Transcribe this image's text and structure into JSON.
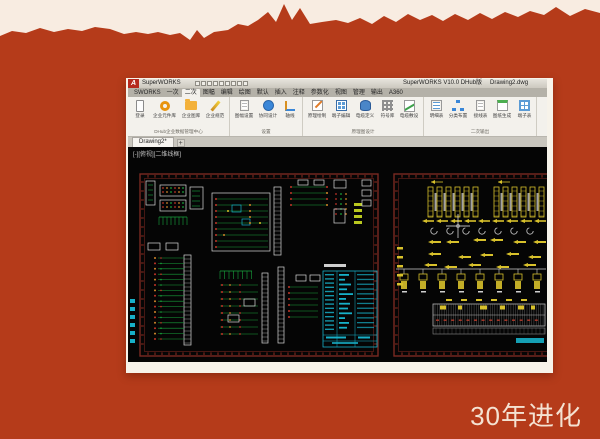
{
  "slide": {
    "caption": "30年进化"
  },
  "window": {
    "titlebar": {
      "app_logo": "A",
      "product_name": "SuperWORKS",
      "document_title": "SuperWORKS V10.0 DHub版",
      "document_name": "Drawing2.dwg",
      "quick_access_icons": [
        "new-file-icon",
        "open-file-icon",
        "save-icon",
        "save-as-icon",
        "undo-icon",
        "redo-icon",
        "plot-icon",
        "refresh-icon",
        "customize-dropdown-icon"
      ]
    },
    "ribbon": {
      "tabs": [
        {
          "label": "SWORKS",
          "active": false
        },
        {
          "label": "一次",
          "active": false
        },
        {
          "label": "二次",
          "active": true
        },
        {
          "label": "图幅",
          "active": false
        },
        {
          "label": "编辑",
          "active": false
        },
        {
          "label": "绘图",
          "active": false
        },
        {
          "label": "默认",
          "active": false
        },
        {
          "label": "插入",
          "active": false
        },
        {
          "label": "注释",
          "active": false
        },
        {
          "label": "参数化",
          "active": false
        },
        {
          "label": "视图",
          "active": false
        },
        {
          "label": "管理",
          "active": false
        },
        {
          "label": "输出",
          "active": false
        },
        {
          "label": "A360",
          "active": false
        }
      ],
      "groups": [
        {
          "label": "DHub企业数据管理中心",
          "buttons": [
            {
              "label": "登录",
              "icon": "tablet-icon"
            },
            {
              "label": "企业元件库",
              "icon": "ring-icon"
            },
            {
              "label": "企业图库",
              "icon": "folder-icon"
            },
            {
              "label": "企业规范",
              "icon": "wand-icon"
            }
          ]
        },
        {
          "label": "设置",
          "buttons": [
            {
              "label": "图幅设置",
              "icon": "doc-icon"
            },
            {
              "label": "协同设计",
              "icon": "blue-circle-icon"
            },
            {
              "label": "轴线",
              "icon": "axis-icon"
            }
          ]
        },
        {
          "label": "原理图设计",
          "buttons": [
            {
              "label": "原理绘制",
              "icon": "pencil-icon"
            },
            {
              "label": "端子编辑",
              "icon": "grid-icon"
            },
            {
              "label": "电缆定义",
              "icon": "db-icon"
            },
            {
              "label": "符号库",
              "icon": "minigrid-icon"
            },
            {
              "label": "电缆敷设",
              "icon": "cable-icon"
            }
          ]
        },
        {
          "label": "二次输出",
          "buttons": [
            {
              "label": "明细表",
              "icon": "list-icon"
            },
            {
              "label": "分类布置",
              "icon": "org-icon"
            },
            {
              "label": "接线表",
              "icon": "doc-icon"
            },
            {
              "label": "图纸生成",
              "icon": "gen-icon"
            },
            {
              "label": "端子表",
              "icon": "table-icon"
            }
          ]
        }
      ]
    },
    "file_tabs": {
      "active": "Drawing2*",
      "add": "+"
    },
    "canvas": {
      "viewport_label": "[-][俯视][二维线框]"
    }
  },
  "colors": {
    "background": "#b53b1a",
    "paper": "#f8ece1",
    "caption": "#f4e2d2",
    "sheet_border": "#7a2a22",
    "canvas_green": "#18a43c",
    "canvas_red": "#c23428",
    "canvas_orange": "#d1862a",
    "canvas_yellow": "#d8c12b",
    "canvas_cyan": "#17b0c8",
    "canvas_white": "#d9d9d9"
  }
}
